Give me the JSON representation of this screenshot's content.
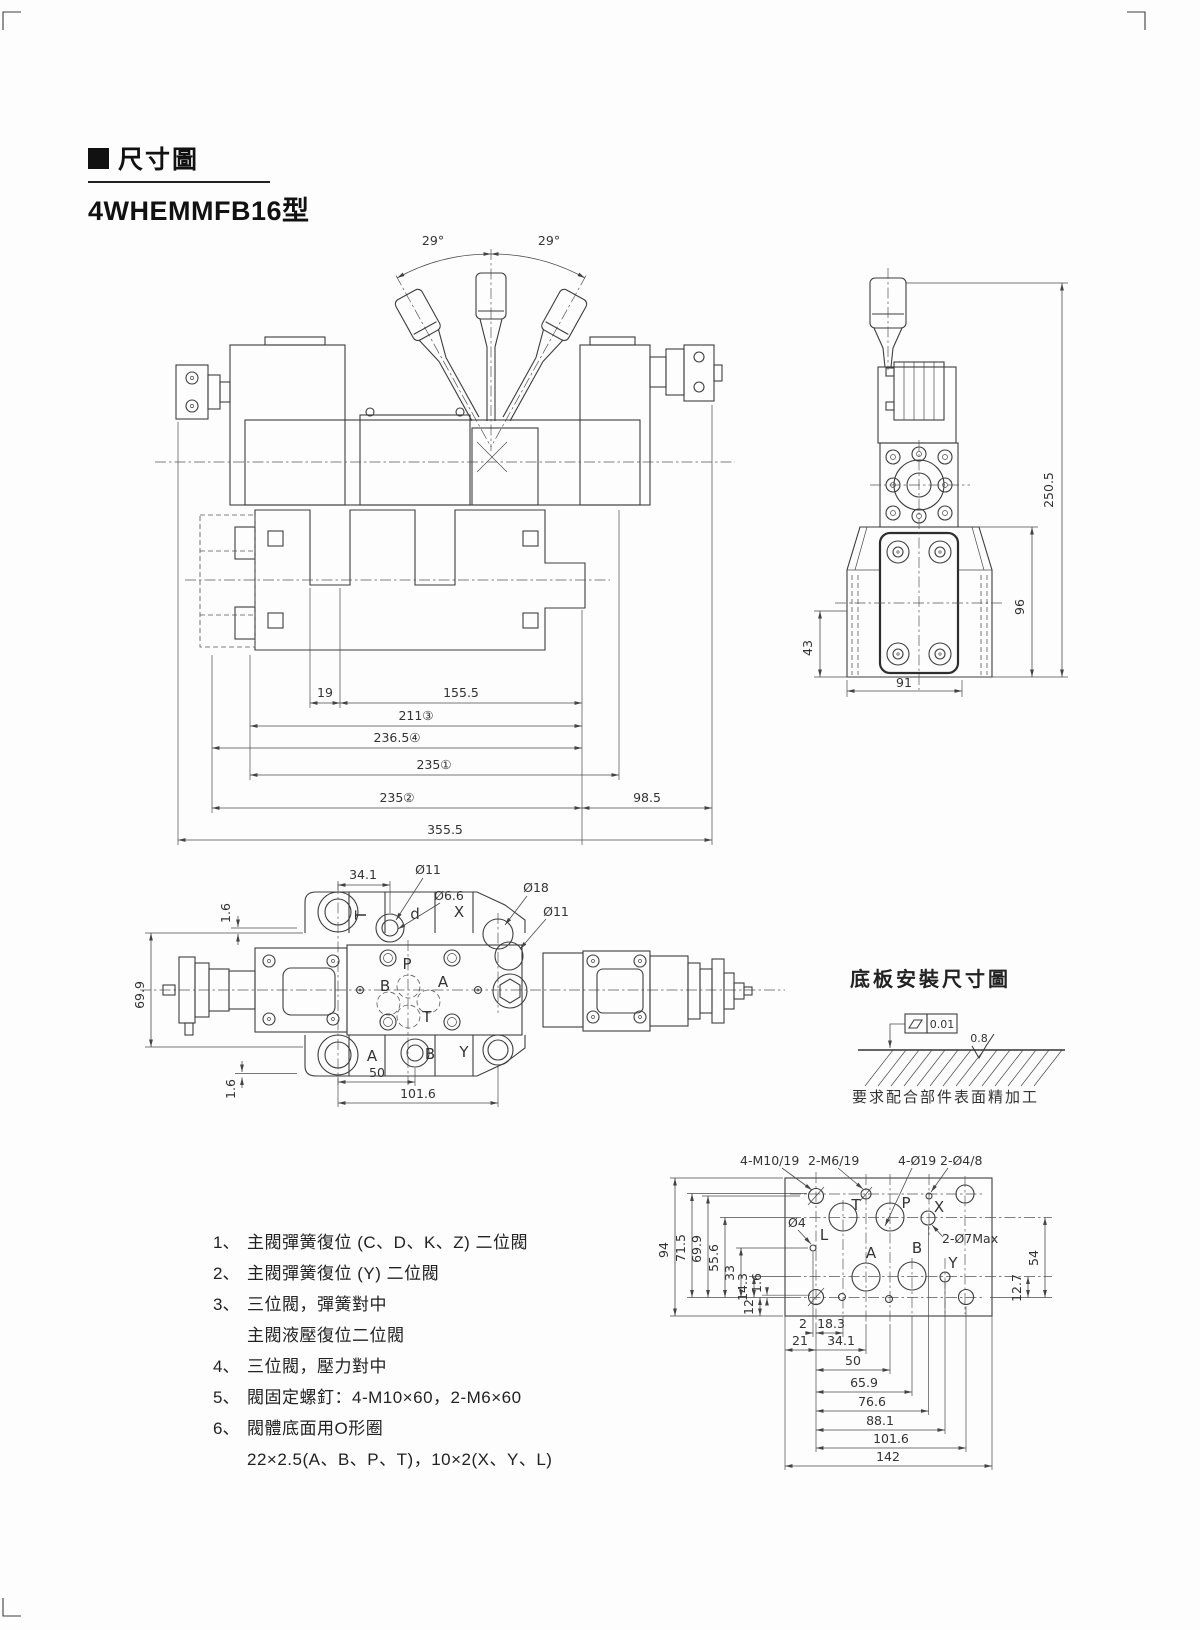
{
  "header": {
    "marker": "■",
    "title": "尺寸圖",
    "model": "4WHEMMFB16型"
  },
  "front_view": {
    "angle_left": "29°",
    "angle_right": "29°",
    "d19": "19",
    "d155": "155.5",
    "d211": "211③",
    "d236": "236.5④",
    "d235a": "235①",
    "d235b": "235②",
    "d98": "98.5",
    "d355": "355.5"
  },
  "side_view": {
    "d250": "250.5",
    "d96": "96",
    "d43": "43",
    "d91": "91"
  },
  "top_view": {
    "d34": "34.1",
    "dia11_top": "Ø11",
    "dia6_6": "Ø6.6",
    "dia18": "Ø18",
    "dia11_right": "Ø11",
    "d69_9": "69.9",
    "d1_6_top": "1.6",
    "d1_6_bottom": "1.6",
    "d50": "50",
    "d101_6": "101.6",
    "label_t_rot": "T",
    "label_d": "d",
    "label_x": "X",
    "port_p": "P",
    "port_b": "B",
    "port_a": "A",
    "port_t": "T",
    "bottom_a": "A",
    "bottom_b": "B",
    "bottom_y": "Y"
  },
  "baseplate_figure": {
    "title": "底板安裝尺寸圖",
    "flatness": "0.01",
    "roughness": "0.8",
    "note": "要求配合部件表面精加工"
  },
  "notes": {
    "items": [
      {
        "no": "1、",
        "text": "主閥彈簧復位 (C、D、K、Z) 二位閥"
      },
      {
        "no": "2、",
        "text": "主閥彈簧復位 (Y) 二位閥"
      },
      {
        "no": "3、",
        "text": "三位閥，彈簧對中"
      },
      {
        "no": "",
        "text": "主閥液壓復位二位閥"
      },
      {
        "no": "4、",
        "text": "三位閥，壓力對中"
      },
      {
        "no": "5、",
        "text": "閥固定螺釘：4-M10×60，2-M6×60"
      },
      {
        "no": "6、",
        "text": "閥體底面用O形圈"
      },
      {
        "no": "",
        "text": "22×2.5(A、B、P、T)，10×2(X、Y、L)"
      }
    ]
  },
  "plate": {
    "lbl_m10": "4-M10/19",
    "lbl_m6": "2-M6/19",
    "lbl_d19": "4-Ø19",
    "lbl_d48": "2-Ø4/8",
    "lbl_d4": "Ø4",
    "lbl_d7": "2-Ø7Max",
    "port_t": "T",
    "port_p": "P",
    "port_x": "X",
    "port_l": "L",
    "port_a": "A",
    "port_b": "B",
    "port_y": "Y",
    "d94": "94",
    "d71_5": "71.5",
    "d69_9": "69.9",
    "d55_6": "55.6",
    "d33": "33",
    "d14_3": "14.3",
    "d1_6": "1.6",
    "d12": "12",
    "d2": "2",
    "d18_3": "18.3",
    "d21": "21",
    "d34_1": "34.1",
    "d50": "50",
    "d65_9": "65.9",
    "d76_6": "76.6",
    "d88_1": "88.1",
    "d101_6": "101.6",
    "d142": "142",
    "d12_7": "12.7",
    "d54": "54"
  }
}
